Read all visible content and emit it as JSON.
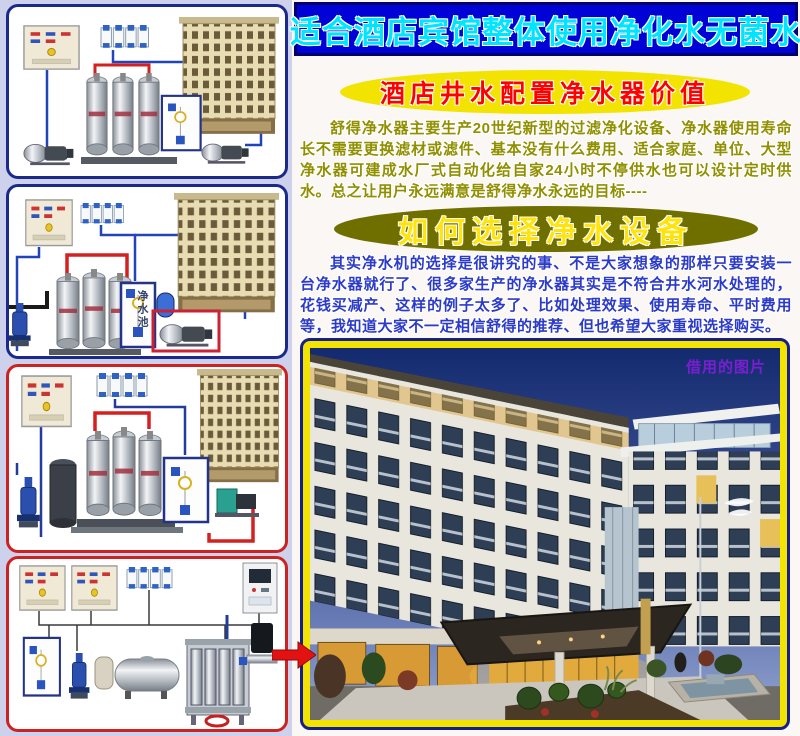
{
  "banner": {
    "text": "适合酒店宾馆整体使用净化水无菌水"
  },
  "value_section": {
    "title": "酒店井水配置净水器价值",
    "body": "舒得净水器主要生产20世纪新型的过滤净化设备、净水器使用寿命长不需要更换滤材或滤件、基本没有什么费用、适合家庭、单位、大型净水器可建成水厂式自动化给自家24小时不停供水也可以设计定时供水。总之让用户永远满意是舒得净水永远的目标----"
  },
  "choose_section": {
    "title": "如何选择净水设备",
    "body": "其实净水机的选择是很讲究的事、不是大家想象的那样只要安装一台净水器就行了、很多家生产的净水器其实是不符合井水河水处理的，花钱买减产、这样的例子太多了、比如处理效果、使用寿命、平时费用等，我知道大家不一定相信舒得的推荐、但也希望大家重视选择购买。"
  },
  "photo": {
    "watermark": "借用的图片"
  },
  "panels": {
    "tank_label": "净水池"
  },
  "colors": {
    "banner_bg": "#0102d5",
    "banner_text": "#00e5ff",
    "accent_yellow": "#f2e300",
    "accent_red": "#ff0000",
    "olive_ellipse": "#6f6f00",
    "olive_text": "#8f8f00",
    "blue_text": "#2b3bc8",
    "panel_border_blue": "#1b2a8a",
    "panel_border_red": "#cc2222",
    "page_bg": "#cdd1ec"
  }
}
